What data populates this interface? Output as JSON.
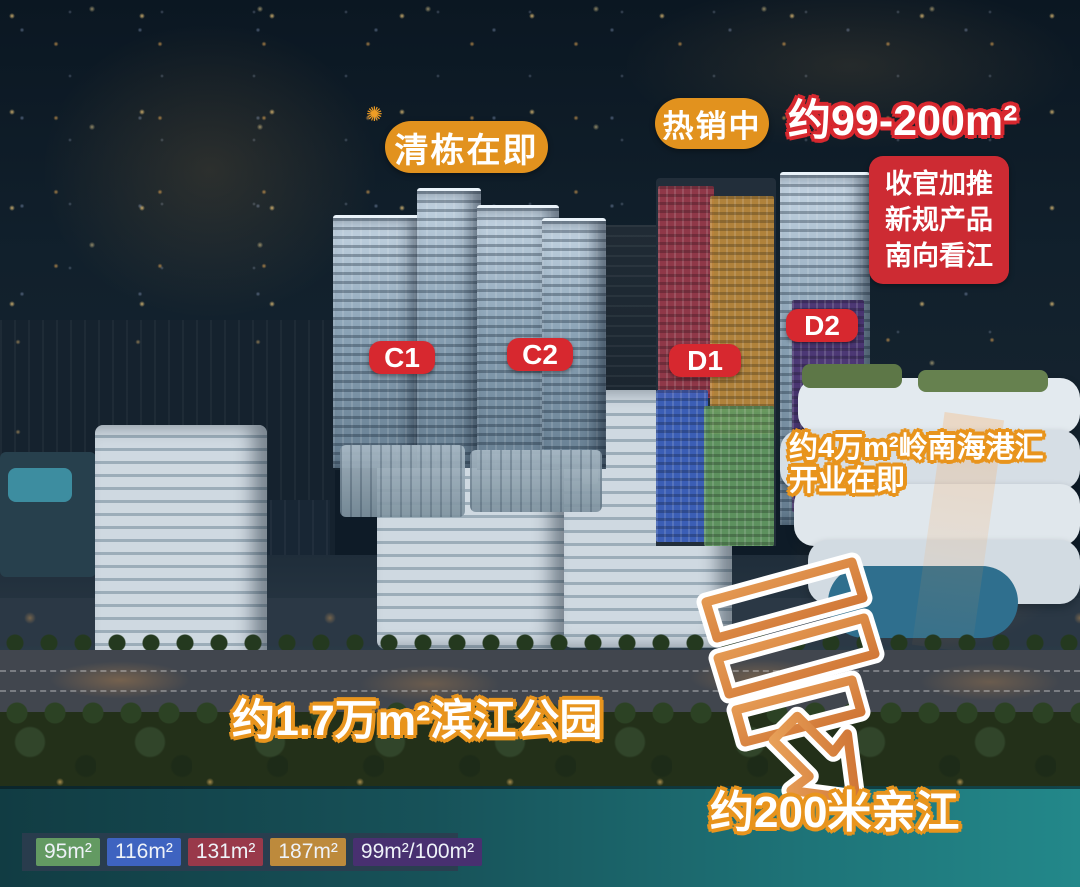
{
  "badges": {
    "clearing_soon": "清栋在即",
    "hot_selling": "热销中",
    "area_range": "约99-200m²",
    "final_push": [
      "收官加推",
      "新规产品",
      "南向看江"
    ]
  },
  "tower_labels": {
    "c1": "C1",
    "c2": "C2",
    "d1": "D1",
    "d2": "D2"
  },
  "annotations": {
    "mall_line1": "约4万m²岭南海港汇",
    "mall_line2": "开业在即",
    "riverside_park": "约1.7万m²滨江公园",
    "river_distance": "约200米亲江"
  },
  "legend": {
    "items": [
      {
        "label": "95m²",
        "color": "#639a62"
      },
      {
        "label": "116m²",
        "color": "#3e63c0"
      },
      {
        "label": "131m²",
        "color": "#99394a"
      },
      {
        "label": "187m²",
        "color": "#bd8a3c"
      },
      {
        "label": "99m²/100m²",
        "color": "#483070"
      }
    ]
  },
  "colors": {
    "badge_orange": "#e2921e",
    "label_red": "#d7282f",
    "panel_red": "#cd2b33",
    "text_outline_orange": "#e8941d",
    "text_outline_red": "#d7282f",
    "arrow_orange": "#d97f35"
  }
}
